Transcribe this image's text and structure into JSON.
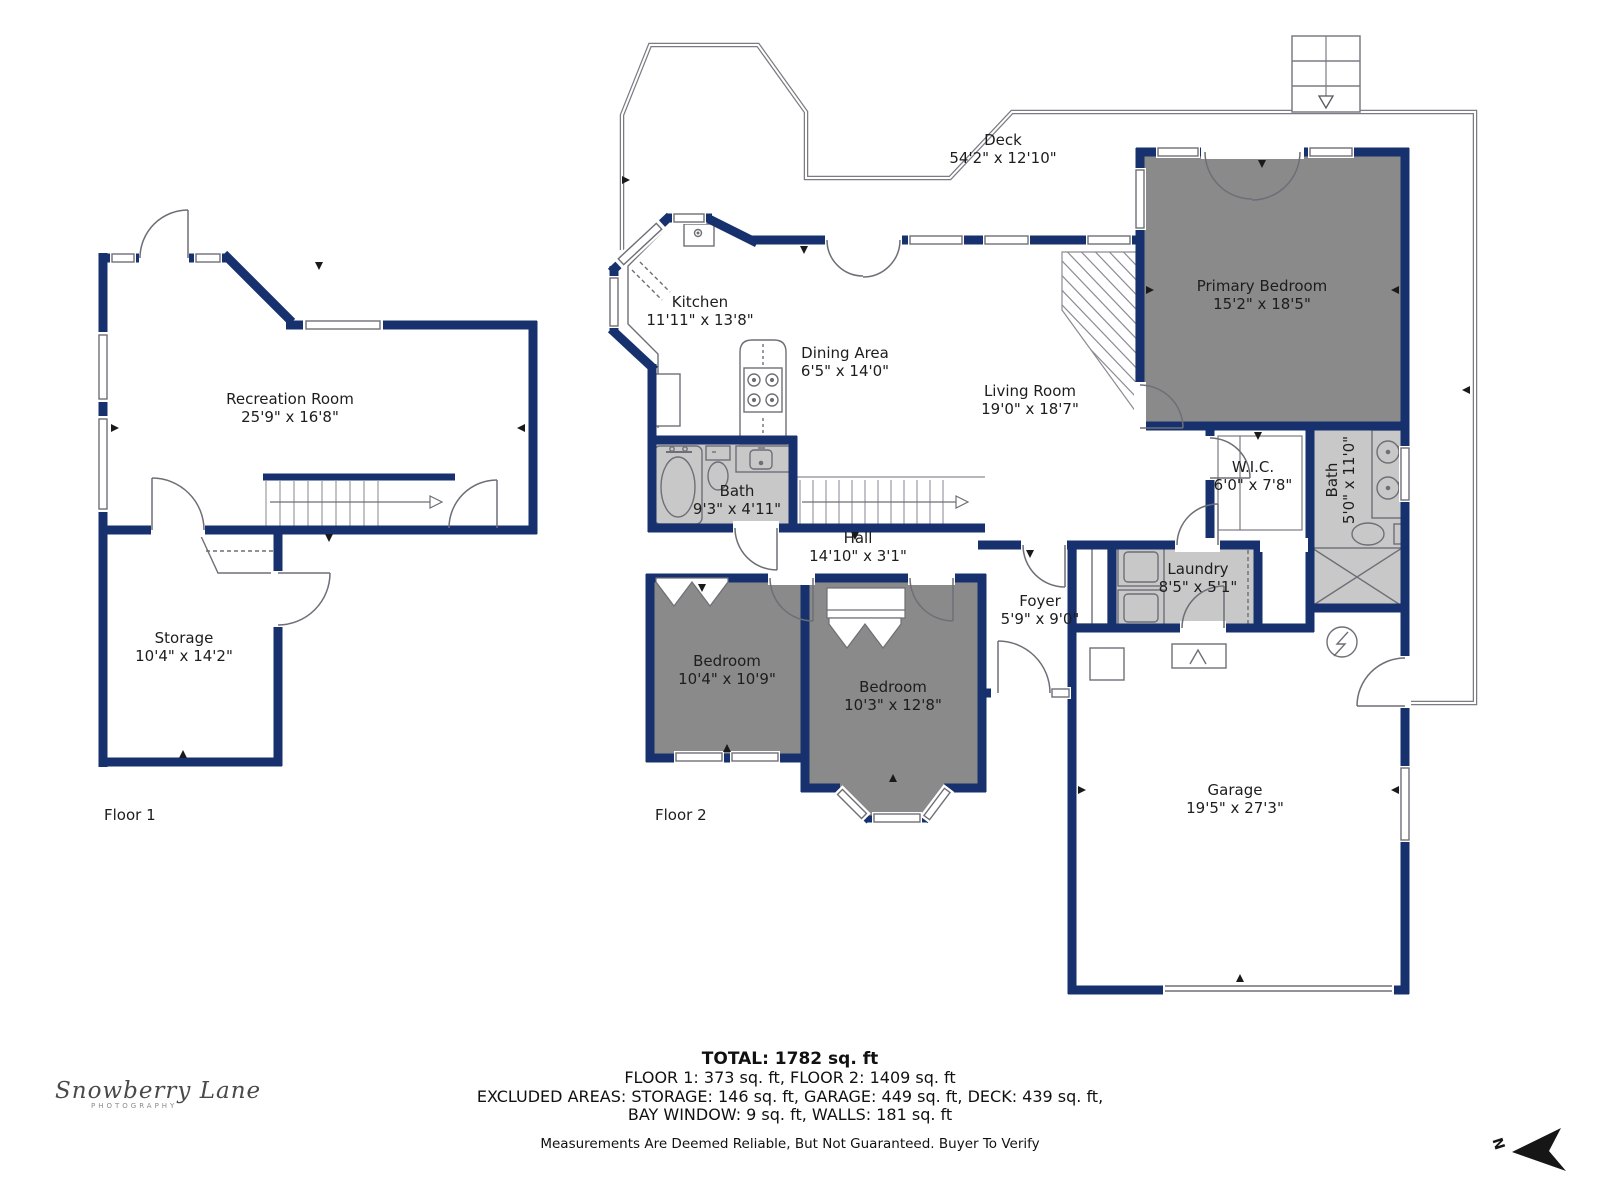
{
  "floors": {
    "floor1": "Floor 1",
    "floor2": "Floor 2"
  },
  "rooms": {
    "recreation": {
      "name": "Recreation Room",
      "dims": "25'9\" x 16'8\""
    },
    "storage": {
      "name": "Storage",
      "dims": "10'4\" x 14'2\""
    },
    "deck": {
      "name": "Deck",
      "dims": "54'2\" x 12'10\""
    },
    "kitchen": {
      "name": "Kitchen",
      "dims": "11'11\" x 13'8\""
    },
    "dining": {
      "name": "Dining Area",
      "dims": "6'5\" x 14'0\""
    },
    "living": {
      "name": "Living Room",
      "dims": "19'0\" x 18'7\""
    },
    "primary_bedroom": {
      "name": "Primary Bedroom",
      "dims": "15'2\" x 18'5\""
    },
    "bath_main": {
      "name": "Bath",
      "dims": "9'3\" x 4'11\""
    },
    "hall": {
      "name": "Hall",
      "dims": "14'10\" x 3'1\""
    },
    "wic": {
      "name": "W.I.C.",
      "dims": "6'0\" x 7'8\""
    },
    "bath_primary": {
      "name": "Bath",
      "dims": "5'0\" x 11'0\""
    },
    "laundry": {
      "name": "Laundry",
      "dims": "8'5\" x 5'1\""
    },
    "foyer": {
      "name": "Foyer",
      "dims": "5'9\" x 9'0\""
    },
    "bedroom_1": {
      "name": "Bedroom",
      "dims": "10'4\" x 10'9\""
    },
    "bedroom_2": {
      "name": "Bedroom",
      "dims": "10'3\" x 12'8\""
    },
    "garage": {
      "name": "Garage",
      "dims": "19'5\" x 27'3\""
    }
  },
  "summary": {
    "total": "TOTAL: 1782 sq. ft",
    "line1": "FLOOR 1: 373 sq. ft, FLOOR 2: 1409 sq. ft",
    "line2": "EXCLUDED AREAS: STORAGE: 146 sq. ft, GARAGE: 449 sq. ft, DECK: 439 sq. ft,",
    "line3": "BAY WINDOW: 9 sq. ft, WALLS: 181 sq. ft",
    "disclaimer": "Measurements Are Deemed Reliable, But Not Guaranteed. Buyer To Verify"
  },
  "branding": {
    "logo_script": "Snowberry Lane",
    "logo_sub": "PHOTOGRAPHY",
    "north_label": "N"
  },
  "colors": {
    "wall_navy": "#16316d",
    "room_dark_gray": "#8a8a8a",
    "room_light_gray": "#c8c8c8",
    "line_gray": "#6e6e77"
  }
}
